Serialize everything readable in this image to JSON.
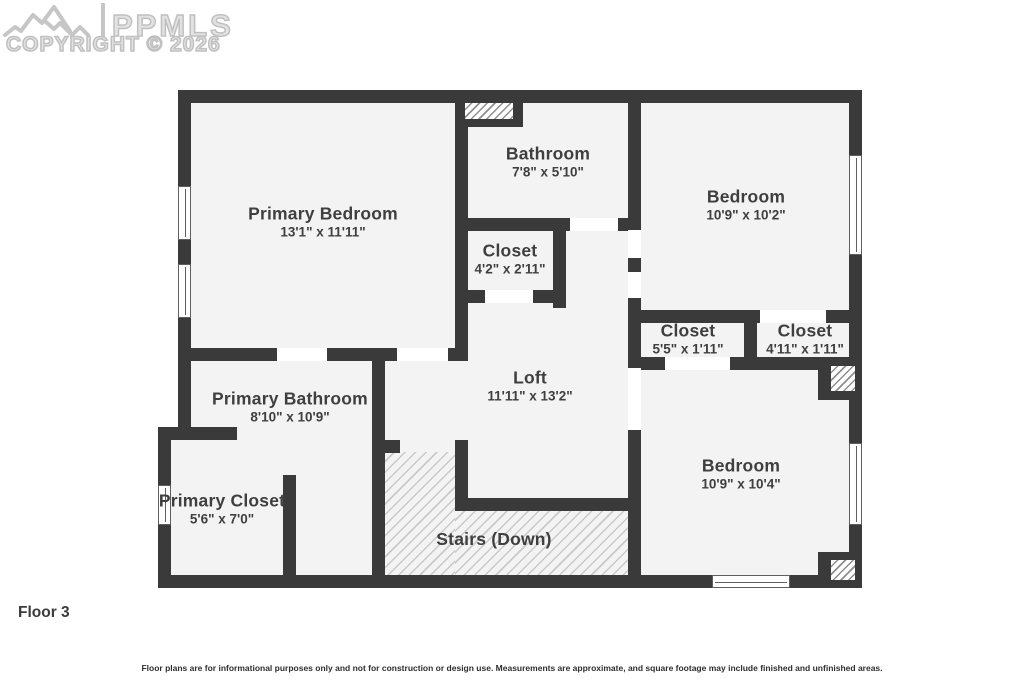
{
  "watermark": {
    "brand": "PPMLS",
    "copyright": "COPYRIGHT © 2026"
  },
  "rooms": {
    "primary_bedroom": {
      "name": "Primary Bedroom",
      "dims": "13'1\" x 11'11\""
    },
    "bathroom": {
      "name": "Bathroom",
      "dims": "7'8\" x 5'10\""
    },
    "bedroom_top_right": {
      "name": "Bedroom",
      "dims": "10'9\" x 10'2\""
    },
    "closet_hall": {
      "name": "Closet",
      "dims": "4'2\" x 2'11\""
    },
    "closet_mid_left": {
      "name": "Closet",
      "dims": "5'5\" x 1'11\""
    },
    "closet_mid_right": {
      "name": "Closet",
      "dims": "4'11\" x 1'11\""
    },
    "loft": {
      "name": "Loft",
      "dims": "11'11\" x 13'2\""
    },
    "primary_bathroom": {
      "name": "Primary Bathroom",
      "dims": "8'10\" x 10'9\""
    },
    "primary_closet": {
      "name": "Primary Closet",
      "dims": "5'6\" x 7'0\""
    },
    "bedroom_bottom_right": {
      "name": "Bedroom",
      "dims": "10'9\" x 10'4\""
    },
    "stairs": {
      "name": "Stairs (Down)"
    }
  },
  "footer": {
    "floor_label": "Floor 3",
    "disclaimer": "Floor plans are for informational purposes only and not for construction or design use. Measurements are approximate, and square footage may include finished and unfinished areas."
  },
  "colors": {
    "wall": "#3a3a3a",
    "floor": "#f3f3f3",
    "door_opening": "#ffffff",
    "stair_hatch_line": "#c9c9c9",
    "label_text": "#3f3f3f",
    "watermark": "#c6c6c6"
  }
}
